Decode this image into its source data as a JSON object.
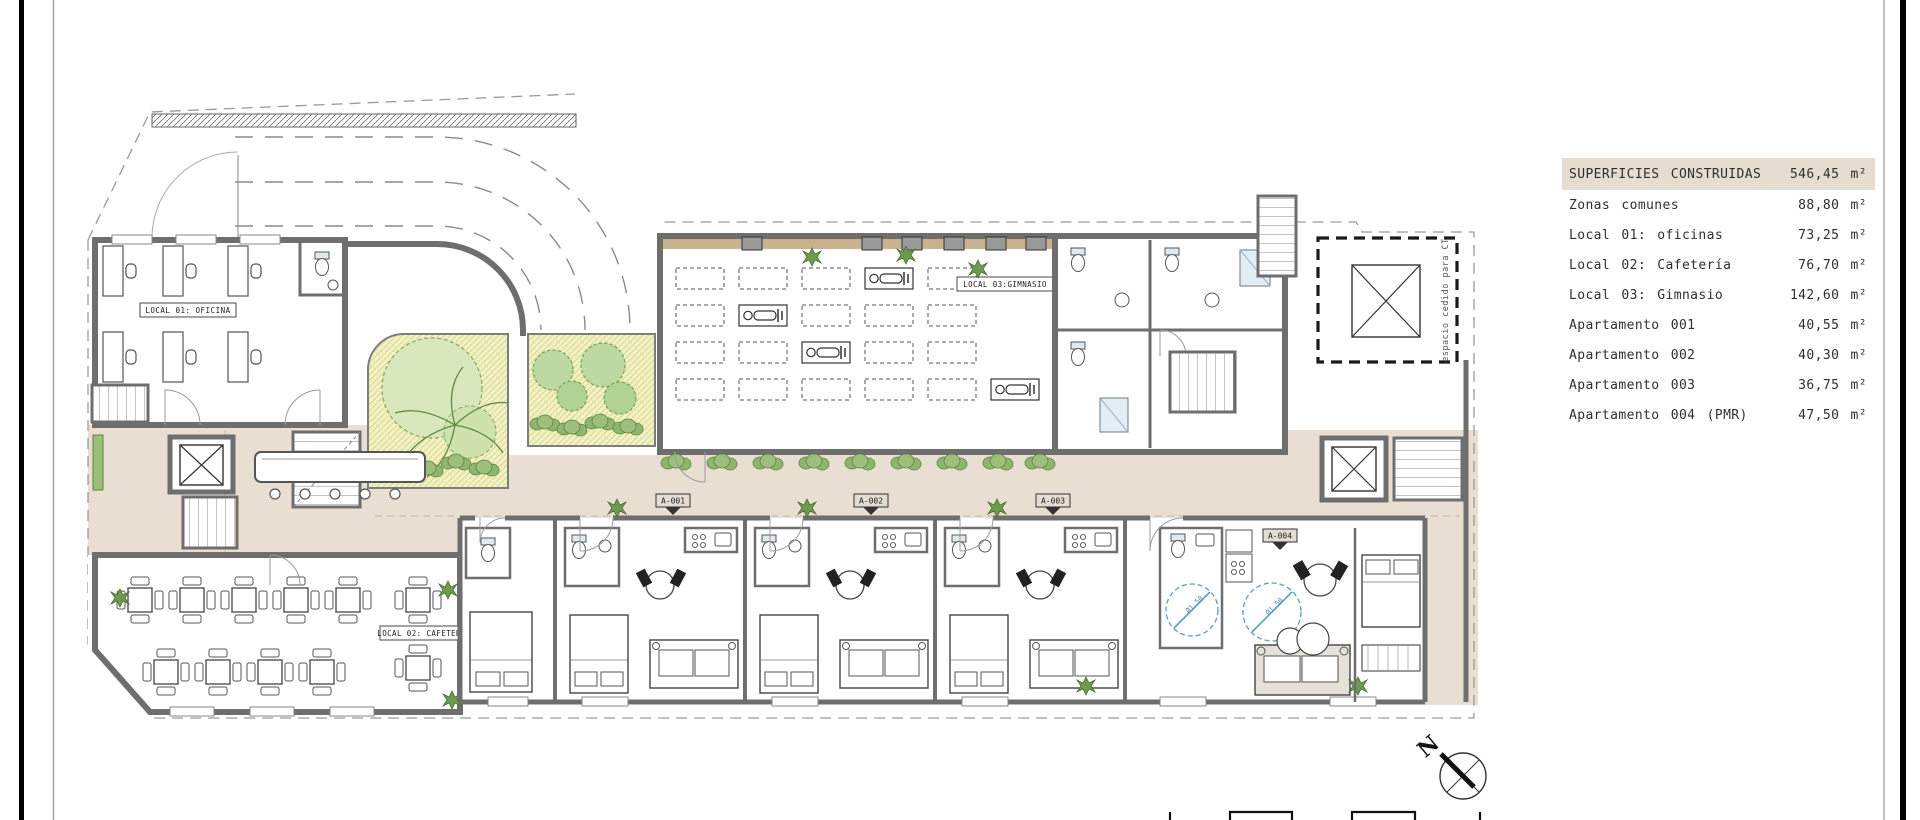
{
  "legend_table": {
    "header": {
      "label": "SUPERFICIES CONSTRUIDAS",
      "value": "546,45 m²"
    },
    "rows": [
      {
        "label": "Zonas comunes",
        "value": "88,80 m²"
      },
      {
        "label": "Local 01: oficinas",
        "value": "73,25 m²"
      },
      {
        "label": "Local 02: Cafetería",
        "value": "76,70 m²"
      },
      {
        "label": "Local 03: Gimnasio",
        "value": "142,60 m²"
      },
      {
        "label": "Apartamento 001",
        "value": "40,55 m²"
      },
      {
        "label": "Apartamento 002",
        "value": "40,30 m²"
      },
      {
        "label": "Apartamento 003",
        "value": "36,75 m²"
      },
      {
        "label": "Apartamento 004 (PMR)",
        "value": "47,50 m²"
      }
    ]
  },
  "plan": {
    "room_labels": {
      "local01": "LOCAL 01: OFICINA",
      "local02": "LOCAL 02: CAFETERIA",
      "local03": "LOCAL 03:GIMNASIO"
    },
    "unit_tags": [
      "A-001",
      "A-002",
      "A-003",
      "A-004"
    ],
    "ct_note": "espacio cedido para CT",
    "pmr_circle_label": "Ø1,50",
    "north_label": "N"
  },
  "colors": {
    "legend_header_bg": "#e6ddd0",
    "corridor_floor": "#e8ded2",
    "wall_gray": "#6e6e6e",
    "garden_ground": "#f2f2c4",
    "tree_green": "#c2dca6",
    "hedge_green": "#6d9a4e",
    "pmr_blue": "#5f9dc0",
    "door_tan": "#8a6d45",
    "wood_tan": "#c9b18e"
  }
}
